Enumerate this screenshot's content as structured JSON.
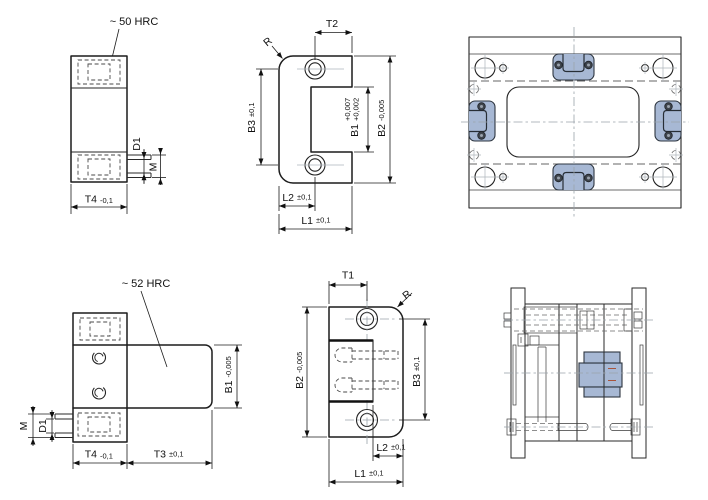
{
  "labels": {
    "hrc50": "~ 50 HRC",
    "hrc52": "~ 52 HRC",
    "t1": "T1",
    "t2": "T2",
    "t3": "T3",
    "t4": "T4",
    "b1": "B1",
    "b2": "B2",
    "b3": "B3",
    "l1": "L1",
    "l2": "L2",
    "d1": "D1",
    "m": "M",
    "r": "R",
    "tol_pm01": "±0,1",
    "tol_m01": "-0,1",
    "tol_m0005": "-0,005",
    "b1_tol_upper": "+0,007",
    "b1_tol_lower": "+0,002"
  },
  "colors": {
    "lock_blue": "#a7b8d4",
    "screw_dark": "#3f454d",
    "screw_center": "#9aa2ad",
    "red_mark": "#a8543c"
  }
}
